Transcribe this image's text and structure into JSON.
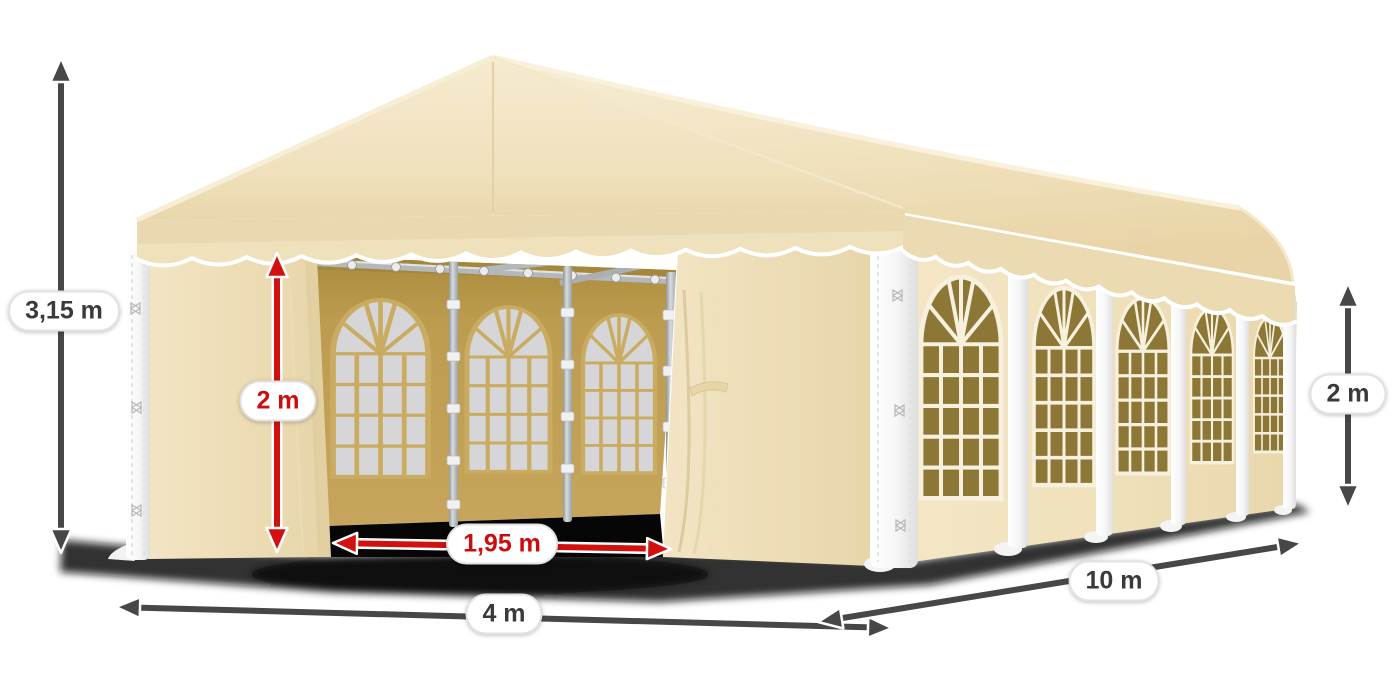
{
  "illustration": {
    "subject": "party-tent-dimensions"
  },
  "labels": {
    "total_height": "3,15 m",
    "entrance_height": "2 m",
    "entrance_width": "1,95 m",
    "front_width": "4 m",
    "side_length": "10 m",
    "side_wall_height": "2 m"
  },
  "colors": {
    "canvas_cream": "#f2e4c2",
    "canvas_shade": "#e7d3a8",
    "window_olive": "#8d7737",
    "interior_gold": "#bd9c50",
    "dimension_red": "#d11010",
    "dimension_dark": "#474745",
    "label_text_dark": "#3a3a3a"
  }
}
